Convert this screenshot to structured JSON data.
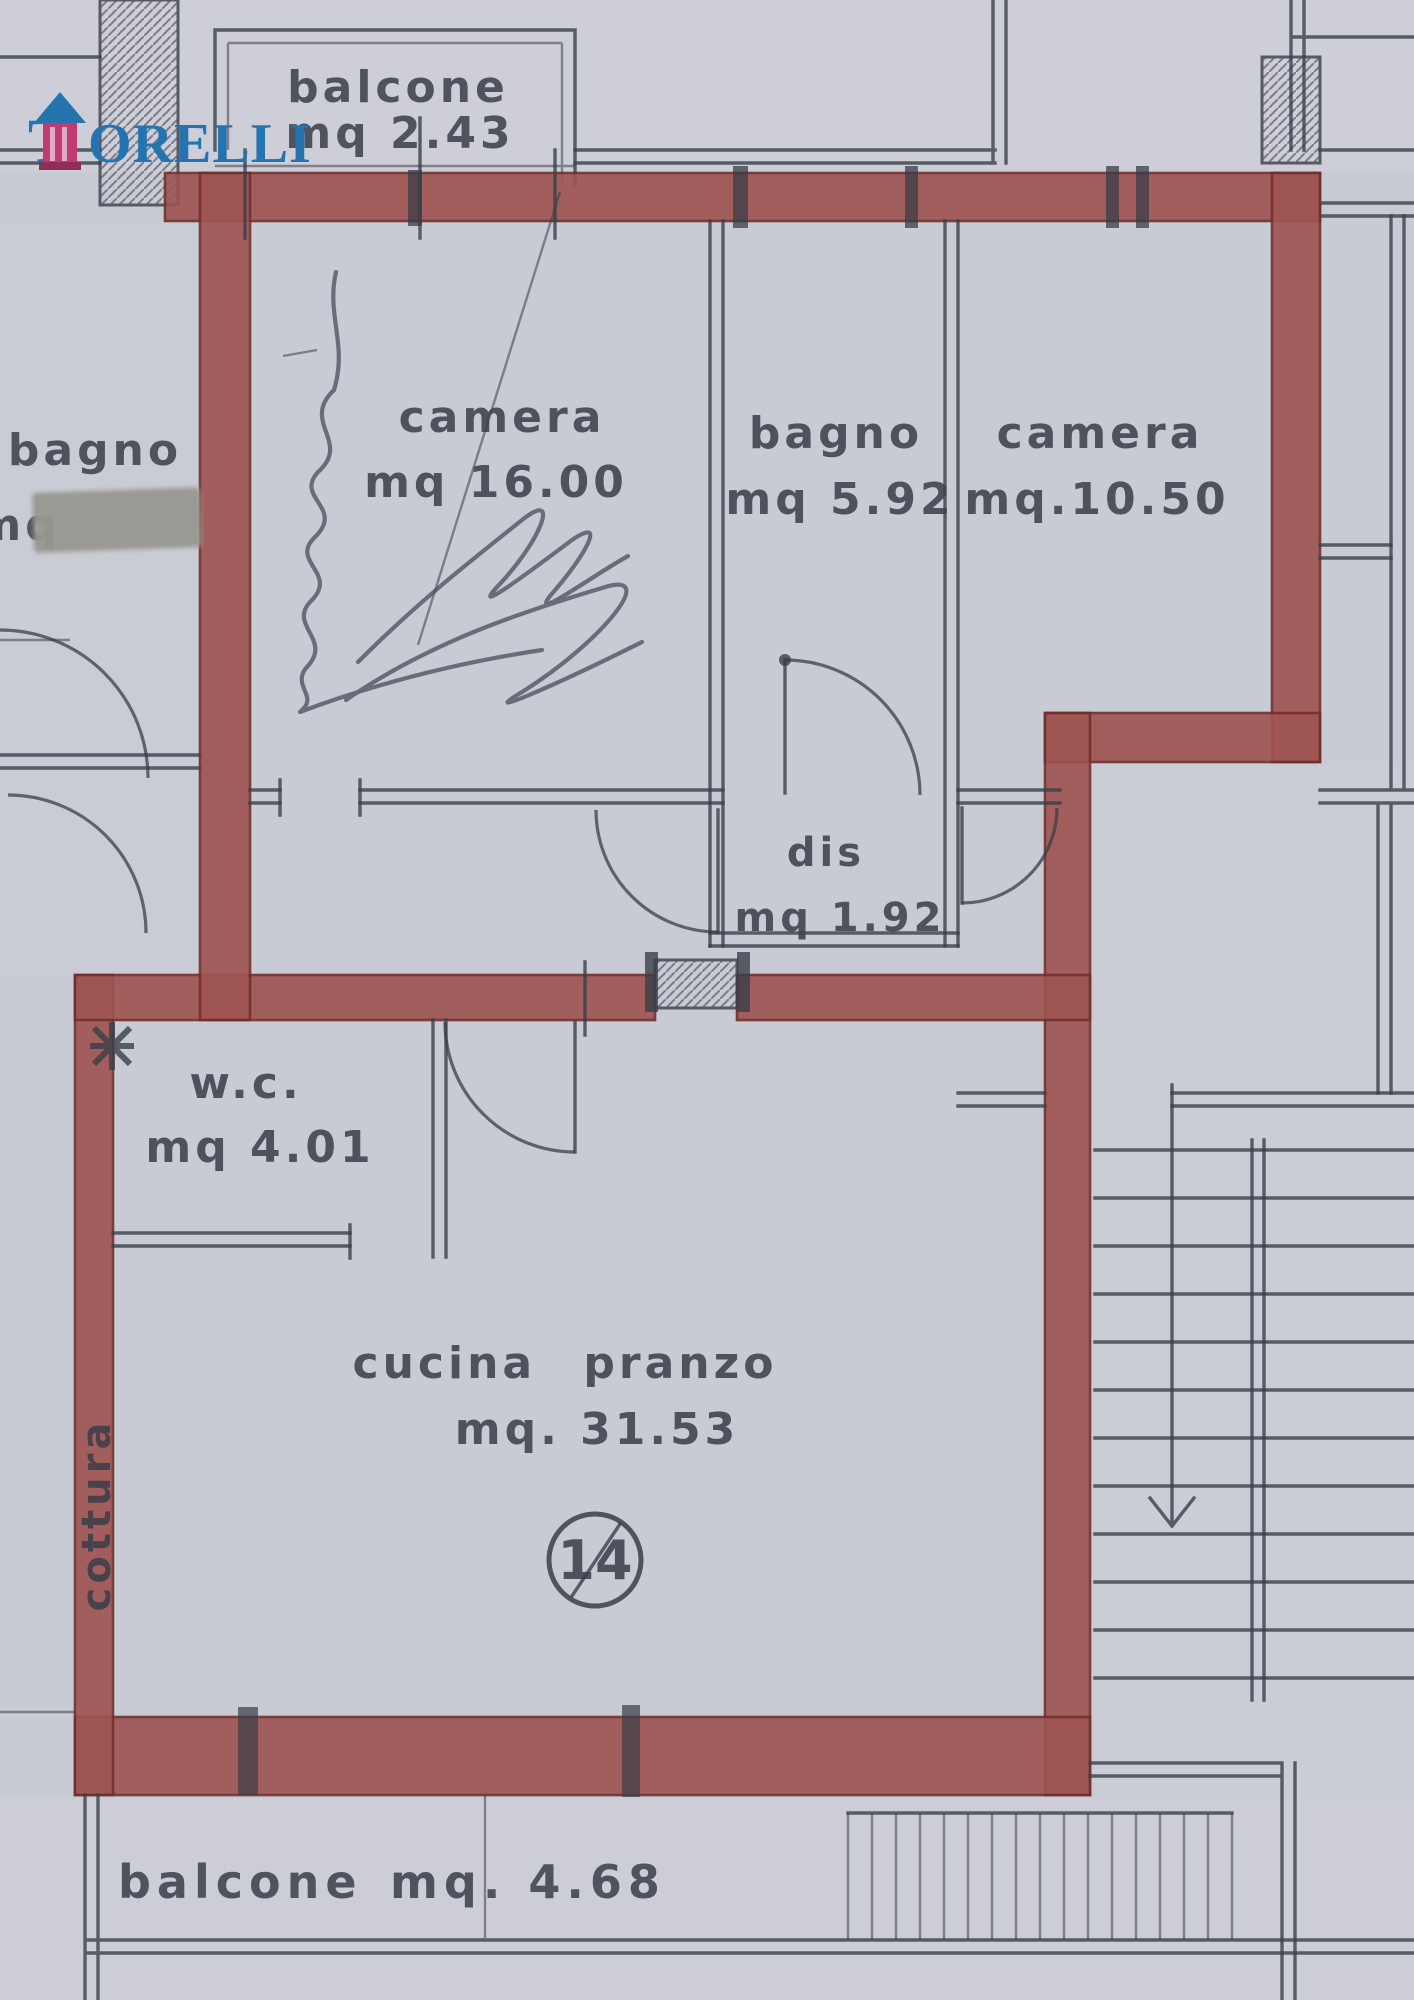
{
  "colors": {
    "paper": "#c8cad4",
    "ink": "#3a3e48",
    "wall_red": "#9e5350",
    "wall_red_dark": "#6f2f2c",
    "logo_blue": "#2574b0",
    "tower_pink": "#c23a72"
  },
  "branding": {
    "agency": "TORELLI",
    "logo_t": "T",
    "logo_rest": "ORELLI"
  },
  "unit": {
    "number": "14"
  },
  "rooms": {
    "balcone_top": {
      "name": "balcone",
      "area": "mq 2.43"
    },
    "bagno_left": {
      "name": "bagno",
      "area": "mq"
    },
    "camera_grande": {
      "name": "camera",
      "area": "mq 16.00"
    },
    "bagno": {
      "name": "bagno",
      "area": "mq 5.92"
    },
    "camera_piccola": {
      "name": "camera",
      "area": "mq.10.50"
    },
    "dis": {
      "name": "dis",
      "area": "mq 1.92"
    },
    "wc": {
      "name": "w.c.",
      "area": "mq 4.01"
    },
    "cucina": {
      "name": "cucina pranzo",
      "area": "mq. 31.53"
    },
    "cottura": {
      "name": "cottura"
    },
    "balcone_bottom": {
      "name": "balcone",
      "area": "mq. 4.68"
    }
  }
}
